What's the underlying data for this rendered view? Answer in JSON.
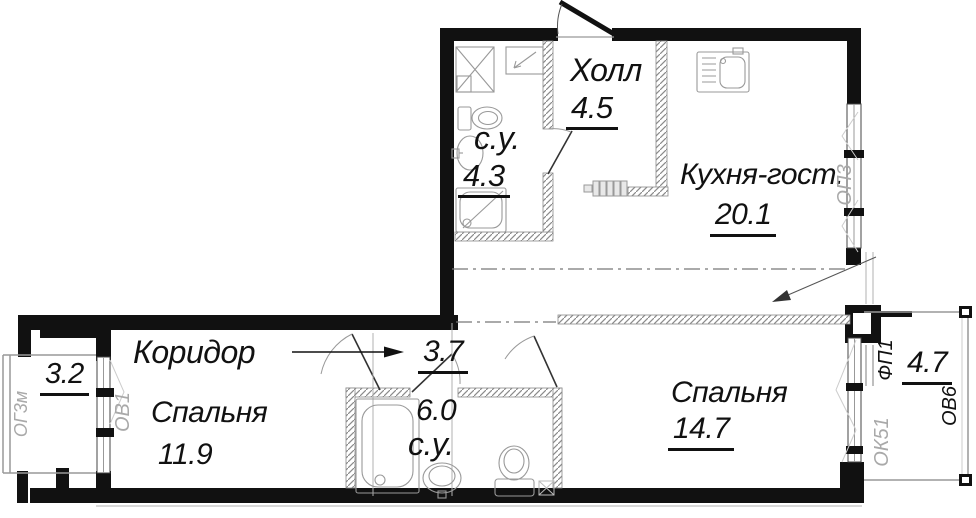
{
  "plan": {
    "rooms": {
      "hall": {
        "name": "Холл",
        "area": "4.5"
      },
      "bathroom_top": {
        "name": "с.у.",
        "area": "4.3"
      },
      "kitchen_living": {
        "name": "Кухня-гост.",
        "area": "20.1"
      },
      "corridor": {
        "name": "Коридор",
        "area": "3.7"
      },
      "bedroom_left": {
        "name": "Спальня",
        "area": "11.9"
      },
      "bathroom_bottom": {
        "name": "с.у.",
        "area": "6.0"
      },
      "bedroom_right": {
        "name": "Спальня",
        "area": "14.7"
      },
      "loggia_left": {
        "area": "3.2"
      },
      "loggia_right": {
        "area": "4.7"
      }
    },
    "window_tags": {
      "op3": "ОП3",
      "fp1": "ФП1",
      "ov6": "ОВ6",
      "ok51": "ОК51",
      "ov1": "ОВ1",
      "og3m": "ОГ3м"
    },
    "colors": {
      "wall": "#111111",
      "partition_hatch": "#8a8a8a",
      "fixture_line": "#999999",
      "muted_tag": "#a9a9a9",
      "text": "#111111",
      "background": "#ffffff"
    }
  }
}
